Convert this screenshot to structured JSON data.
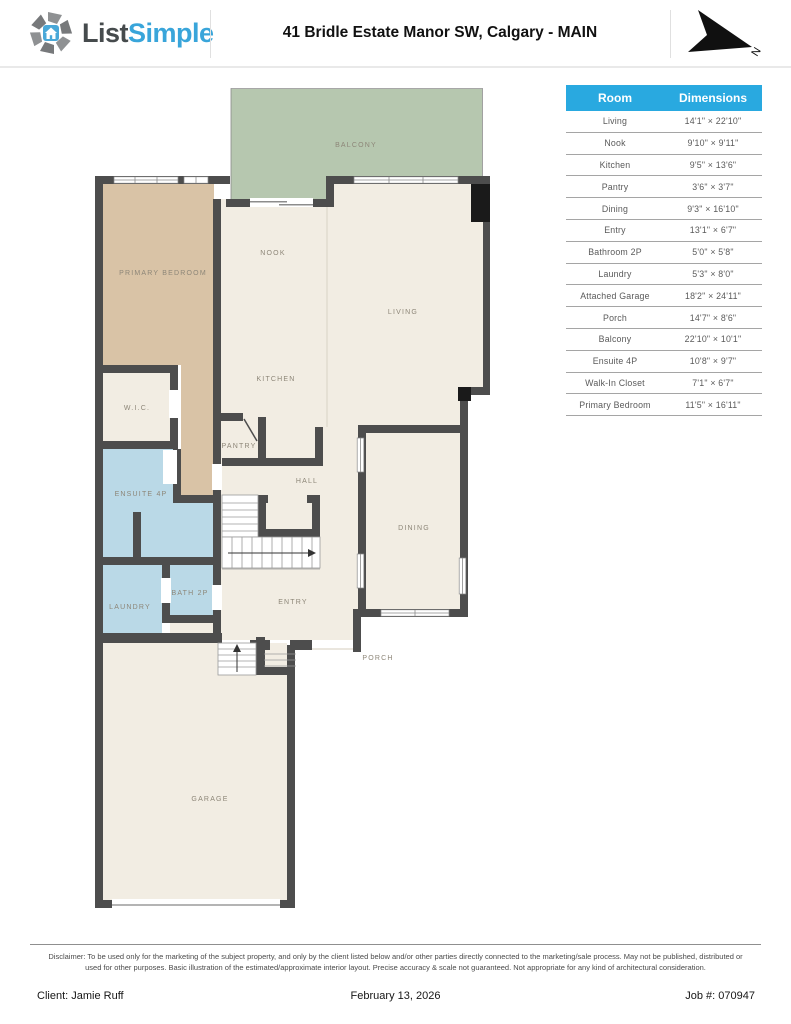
{
  "header": {
    "brand_part1": "List",
    "brand_part2": "Simple",
    "title": "41 Bridle Estate Manor SW, Calgary - MAIN",
    "compass_label": "N"
  },
  "plan": {
    "room_labels": {
      "balcony": "BALCONY",
      "primary_bedroom": "PRIMARY BEDROOM",
      "nook": "NOOK",
      "living": "LIVING",
      "kitchen": "KITCHEN",
      "wic": "W.I.C.",
      "pantry": "PANTRY",
      "hall": "HALL",
      "ensuite": "ENSUITE 4P",
      "dining": "DINING",
      "laundry": "LAUNDRY",
      "bath": "BATH 2P",
      "entry": "ENTRY",
      "porch": "PORCH",
      "garage": "GARAGE"
    },
    "colors": {
      "wall": "#4d4d4d",
      "room_cream": "#f2ede3",
      "room_tan": "#d9c3a6",
      "room_blue": "#bad9e7",
      "room_green": "#b6c7af",
      "label_text": "#8d8678"
    }
  },
  "table": {
    "header_bg": "#29a9e0",
    "headers": [
      "Room",
      "Dimensions"
    ],
    "rows": [
      {
        "room": "Living",
        "dimensions": "14'1\" × 22'10\""
      },
      {
        "room": "Nook",
        "dimensions": "9'10\" × 9'11\""
      },
      {
        "room": "Kitchen",
        "dimensions": "9'5\" × 13'6\""
      },
      {
        "room": "Pantry",
        "dimensions": "3'6\" × 3'7\""
      },
      {
        "room": "Dining",
        "dimensions": "9'3\" × 16'10\""
      },
      {
        "room": "Entry",
        "dimensions": "13'1\" × 6'7\""
      },
      {
        "room": "Bathroom 2P",
        "dimensions": "5'0\" × 5'8\""
      },
      {
        "room": "Laundry",
        "dimensions": "5'3\" × 8'0\""
      },
      {
        "room": "Attached Garage",
        "dimensions": "18'2\" × 24'11\""
      },
      {
        "room": "Porch",
        "dimensions": "14'7\" × 8'6\""
      },
      {
        "room": "Balcony",
        "dimensions": "22'10\" × 10'1\""
      },
      {
        "room": "Ensuite 4P",
        "dimensions": "10'8\" × 9'7\""
      },
      {
        "room": "Walk-In Closet",
        "dimensions": "7'1\" × 6'7\""
      },
      {
        "room": "Primary Bedroom",
        "dimensions": "11'5\" × 16'11\""
      }
    ]
  },
  "footer": {
    "disclaimer": "Disclaimer: To be used only for the marketing of the subject property, and only by the client listed below and/or other parties directly connected to the marketing/sale process. May not be published, distributed or used for other purposes. Basic illustration of the estimated/approximate interior layout. Precise accuracy & scale not guaranteed. Not appropriate for any kind of architectural consideration.",
    "client": "Client: Jamie Ruff",
    "date": "February 13, 2026",
    "job": "Job #: 070947"
  }
}
